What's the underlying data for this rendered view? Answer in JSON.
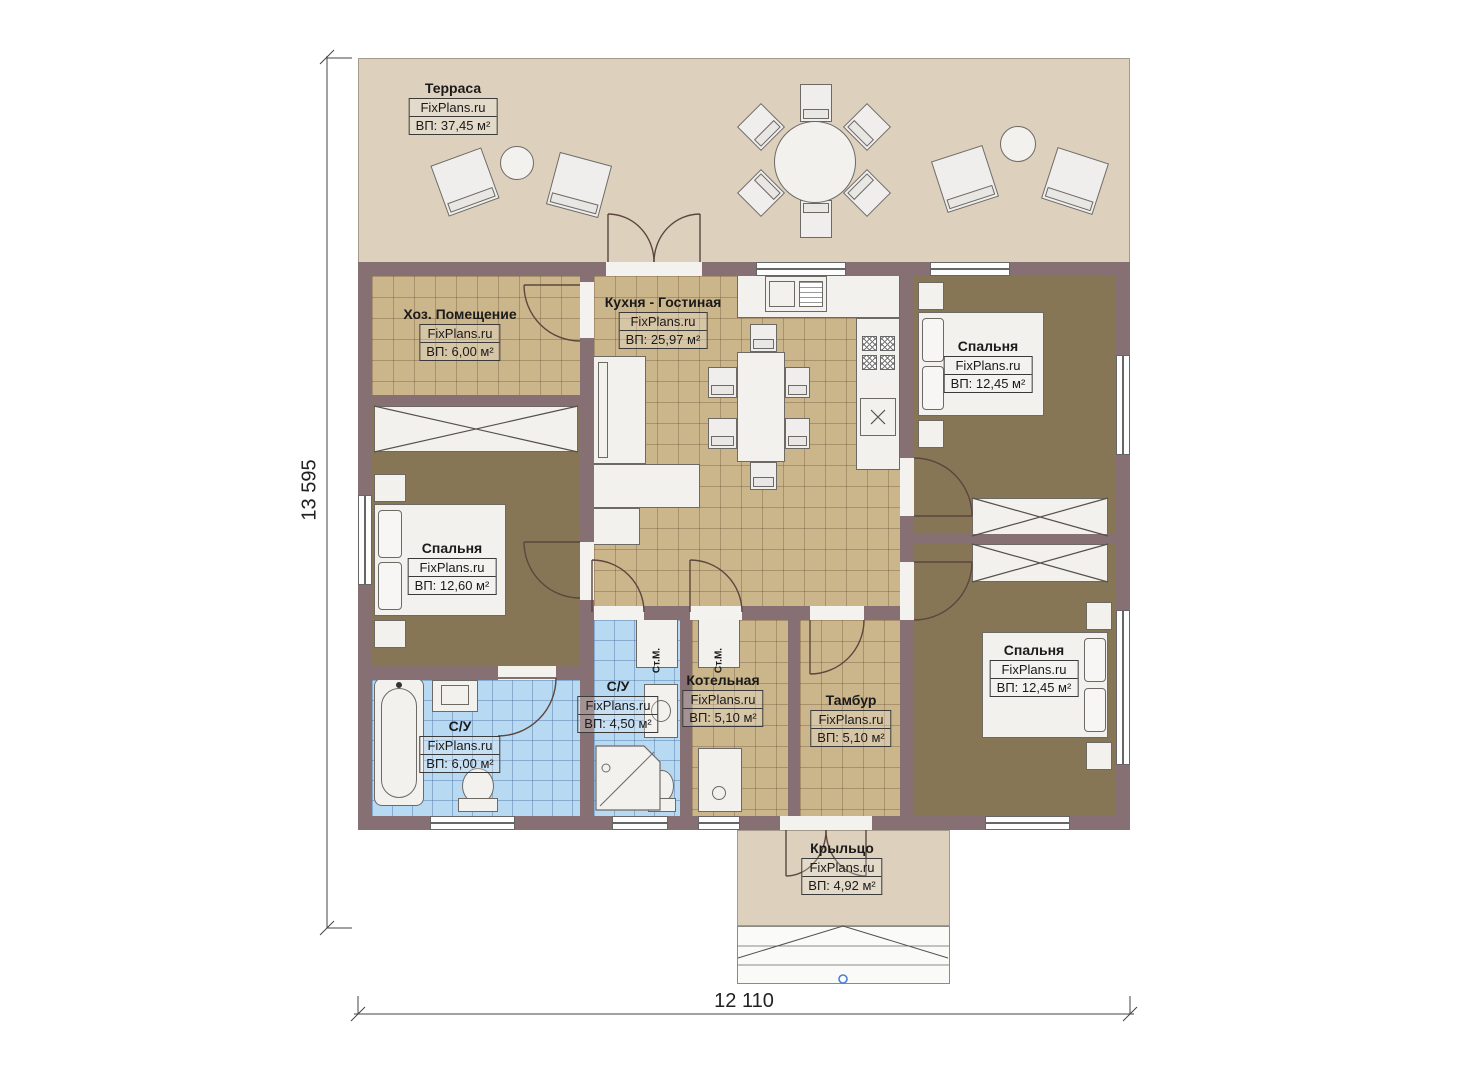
{
  "plan": {
    "rooms": [
      {
        "name": "Терраса",
        "site": "FixPlans.ru",
        "area": "ВП: 37,45 м²"
      },
      {
        "name": "Хоз. Помещение",
        "site": "FixPlans.ru",
        "area": "ВП: 6,00 м²"
      },
      {
        "name": "Кухня - Гостиная",
        "site": "FixPlans.ru",
        "area": "ВП: 25,97 м²"
      },
      {
        "name": "Спальня",
        "site": "FixPlans.ru",
        "area": "ВП: 12,45 м²"
      },
      {
        "name": "Спальня",
        "site": "FixPlans.ru",
        "area": "ВП: 12,60 м²"
      },
      {
        "name": "С/У",
        "site": "FixPlans.ru",
        "area": "ВП: 4,50 м²"
      },
      {
        "name": "С/У",
        "site": "FixPlans.ru",
        "area": "ВП: 6,00 м²"
      },
      {
        "name": "Котельная",
        "site": "FixPlans.ru",
        "area": "ВП: 5,10 м²"
      },
      {
        "name": "Тамбур",
        "site": "FixPlans.ru",
        "area": "ВП: 5,10 м²"
      },
      {
        "name": "Спальня",
        "site": "FixPlans.ru",
        "area": "ВП: 12,45 м²"
      },
      {
        "name": "Крыльцо",
        "site": "FixPlans.ru",
        "area": "ВП: 4,92 м²"
      }
    ],
    "dimensions": {
      "height_label": "13 595",
      "width_label": "12 110"
    },
    "appliance_labels": {
      "washing_machine": "Ст.М."
    },
    "colors": {
      "wall": "#877073",
      "tile_floor": "#cbb68c",
      "carpet_floor": "#867655",
      "bath_floor": "#b7d9f2",
      "terrace": "#ddd0bc",
      "furniture": "#f2f1ee",
      "step_marker": "#4a7fd4"
    }
  }
}
